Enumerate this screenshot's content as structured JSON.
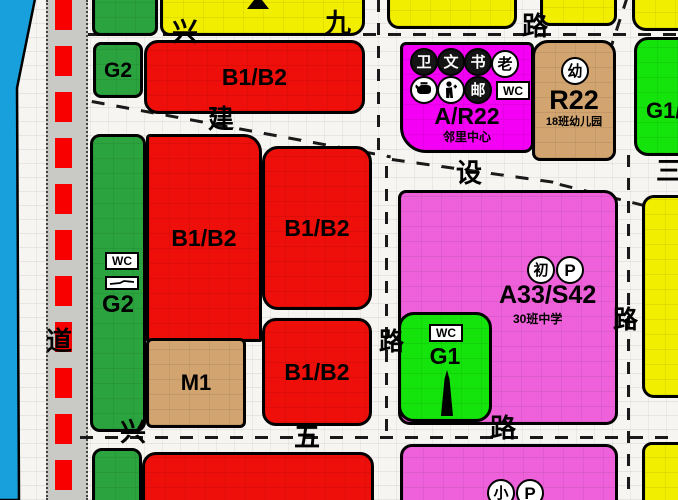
{
  "roads": {
    "top": {
      "name": "兴九路",
      "chars": [
        "兴",
        "九",
        "路"
      ]
    },
    "diagonal": {
      "name": "建设",
      "chars": [
        "建",
        "设"
      ]
    },
    "right_edge_partial": {
      "chars": [
        "三"
      ]
    },
    "left_vertical": {
      "chars": [
        "道"
      ]
    },
    "bottom": {
      "name": "兴五路",
      "chars": [
        "兴",
        "五",
        "路"
      ]
    },
    "vertical_mid": {
      "chars": [
        "路"
      ]
    },
    "vertical_right": {
      "chars": [
        "路"
      ]
    }
  },
  "parcels": {
    "g2_north": {
      "code": "G2"
    },
    "b1b2_north": {
      "code": "B1/B2"
    },
    "neighborhood_center": {
      "code": "A/R22",
      "name": "邻里中心"
    },
    "kindergarten": {
      "code": "R22",
      "name": "18班幼儿园"
    },
    "g1_northeast": {
      "code": "G1/"
    },
    "g2_west": {
      "code": "G2"
    },
    "b1b2_west": {
      "code": "B1/B2"
    },
    "b1b2_mid": {
      "code": "B1/B2"
    },
    "b1b2_south": {
      "code": "B1/B2"
    },
    "m1": {
      "code": "M1"
    },
    "middle_school": {
      "code": "A33/S42",
      "name": "30班中学"
    },
    "g1_park": {
      "code": "G1"
    }
  },
  "icons": {
    "health": "卫",
    "culture": "文",
    "library": "书",
    "elderly": "老",
    "post": "邮",
    "wc": "WC",
    "kindergarten": "幼",
    "junior_school": "初",
    "parking": "P",
    "primary_school": "小"
  },
  "colors": {
    "commercial_red": "#ee0f0a",
    "park_green": "#2ba33e",
    "bright_green": "#14e30c",
    "residential_yellow": "#f2ee00",
    "public_magenta": "#f400f4",
    "school_pink": "#ee61da",
    "industry_tan": "#d2a470",
    "water_blue": "#18a0dc",
    "boundary_red": "#ff0000",
    "road_white": "#f6f5f1"
  }
}
